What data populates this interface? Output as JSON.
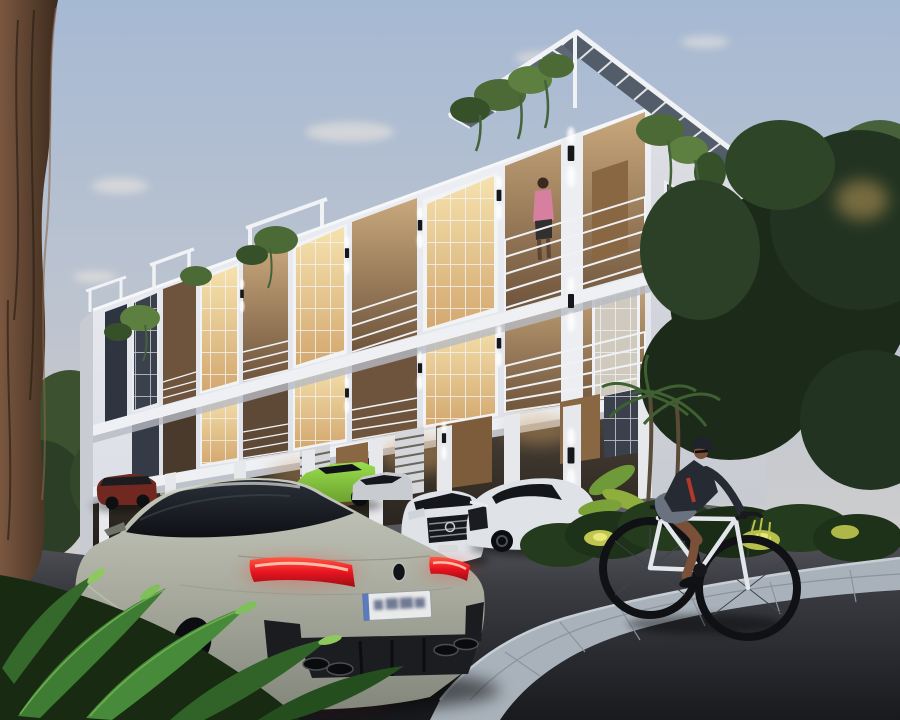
{
  "scene": {
    "kind": "architectural-exterior-render",
    "time_of_day": "dusk",
    "description": "Photorealistic dusk rendering of a modern white three-storey terrace apartment building with a rooftop slatted pergola and hanging vines. Luxury cars are parked at the ground-floor carport, a sage-grey BMW gran coupe dominates the foreground on a dark asphalt road, and a cyclist rides past uplit tropical landscaping on the right.",
    "building": {
      "storeys": 3,
      "features": [
        "rooftop slatted pergola",
        "hanging vine planters on parapets",
        "recessed balconies with white horizontal railings",
        "large gridded windows with warm interior lighting",
        "ground-floor carport with timber doors and louvre screens",
        "black up/down wall sconces on pillars"
      ]
    },
    "objects": [
      {
        "name": "apartment-building",
        "label": "Modern white 3-storey apartment building"
      },
      {
        "name": "rooftop-pergola",
        "label": "Slatted pergola roof structure with vines"
      },
      {
        "name": "balcony-person",
        "label": "Man in a pink shirt standing on an upper balcony"
      },
      {
        "name": "foreground-car",
        "label": "Sage-grey BMW M8 gran coupe seen from the rear"
      },
      {
        "name": "license-plate",
        "label": "White rear licence plate, characters blurred"
      },
      {
        "name": "green-sports-car",
        "label": "Lime-green sports car parked by the carport"
      },
      {
        "name": "white-mercedes-front",
        "label": "White Mercedes with chrome grille facing the street"
      },
      {
        "name": "white-mercedes-coupe",
        "label": "White Mercedes coupe parked at the corner"
      },
      {
        "name": "red-suv",
        "label": "Dark-red SUV parked at the far left"
      },
      {
        "name": "cyclist",
        "label": "Man in dark jacket and grey shorts riding a white bicycle"
      },
      {
        "name": "left-tree-trunk",
        "label": "Large brown tree trunk framing the left edge"
      },
      {
        "name": "foreground-ferns",
        "label": "Green fern fronds in the lower-left foreground"
      },
      {
        "name": "right-trees",
        "label": "Dense dark trees and palms on the right"
      },
      {
        "name": "sidewalk",
        "label": "Curved grey paver walkway with uplit shrubs"
      },
      {
        "name": "road",
        "label": "Dark asphalt road in the foreground"
      }
    ],
    "colors": {
      "sky_top": "#a6b9d3",
      "sky_mid": "#c3c7ce",
      "sky_horizon": "#dcd6cf",
      "building_lit": "#eff1f5",
      "building_lit_low": "#d9dce4",
      "building_shade": "#dfe0e5",
      "building_shade_low": "#c8cad2",
      "pergola_slat": "#5d6874",
      "window_glow_bright": "#f6e2ae",
      "window_glow": "#d3a86f",
      "window_dark": "#3a414d",
      "balcony_warm_top": "#c9a87c",
      "balcony_warm_low": "#6e543c",
      "wood_door": "#8a6743",
      "railing_white": "#eff1f4",
      "vine_green": "#4b6a36",
      "tree_dark": "#1c2a1a",
      "tree_mid": "#2b4026",
      "tree_light": "#47613a",
      "shrub_green": "#243b1e",
      "uplight_yellow": "#c9cf52",
      "trunk_brown": "#7a5740",
      "trunk_dark": "#3c2b1e",
      "fern_green": "#3f7c33",
      "asphalt_far": "#64666c",
      "asphalt_mid": "#3a3c41",
      "asphalt_near": "#191a1e",
      "paver_grey": "#a9b2bb",
      "bmw_body": "#a7aa9d",
      "bmw_body_light": "#c6c8bd",
      "bmw_body_dark": "#84877c",
      "bmw_glass_top": "#2a2f38",
      "bmw_glass": "#0e1014",
      "taillight_red": "#e81420",
      "plate_white": "#e9eaea",
      "lambo_green": "#9ade4e",
      "merc_white": "#dfe2e6",
      "suv_red": "#712820",
      "bike_frame": "#e3e6ea",
      "tire_black": "#101114",
      "jacket_dark": "#262a33",
      "jacket_red": "#c23a2e",
      "shorts_grey": "#6a7280",
      "skin_tan": "#7a5038",
      "shirt_pink": "#d77f9f",
      "helmet_dark": "#202329",
      "sconce_black": "#15171a",
      "light_warm": "#ffe9c0"
    }
  }
}
